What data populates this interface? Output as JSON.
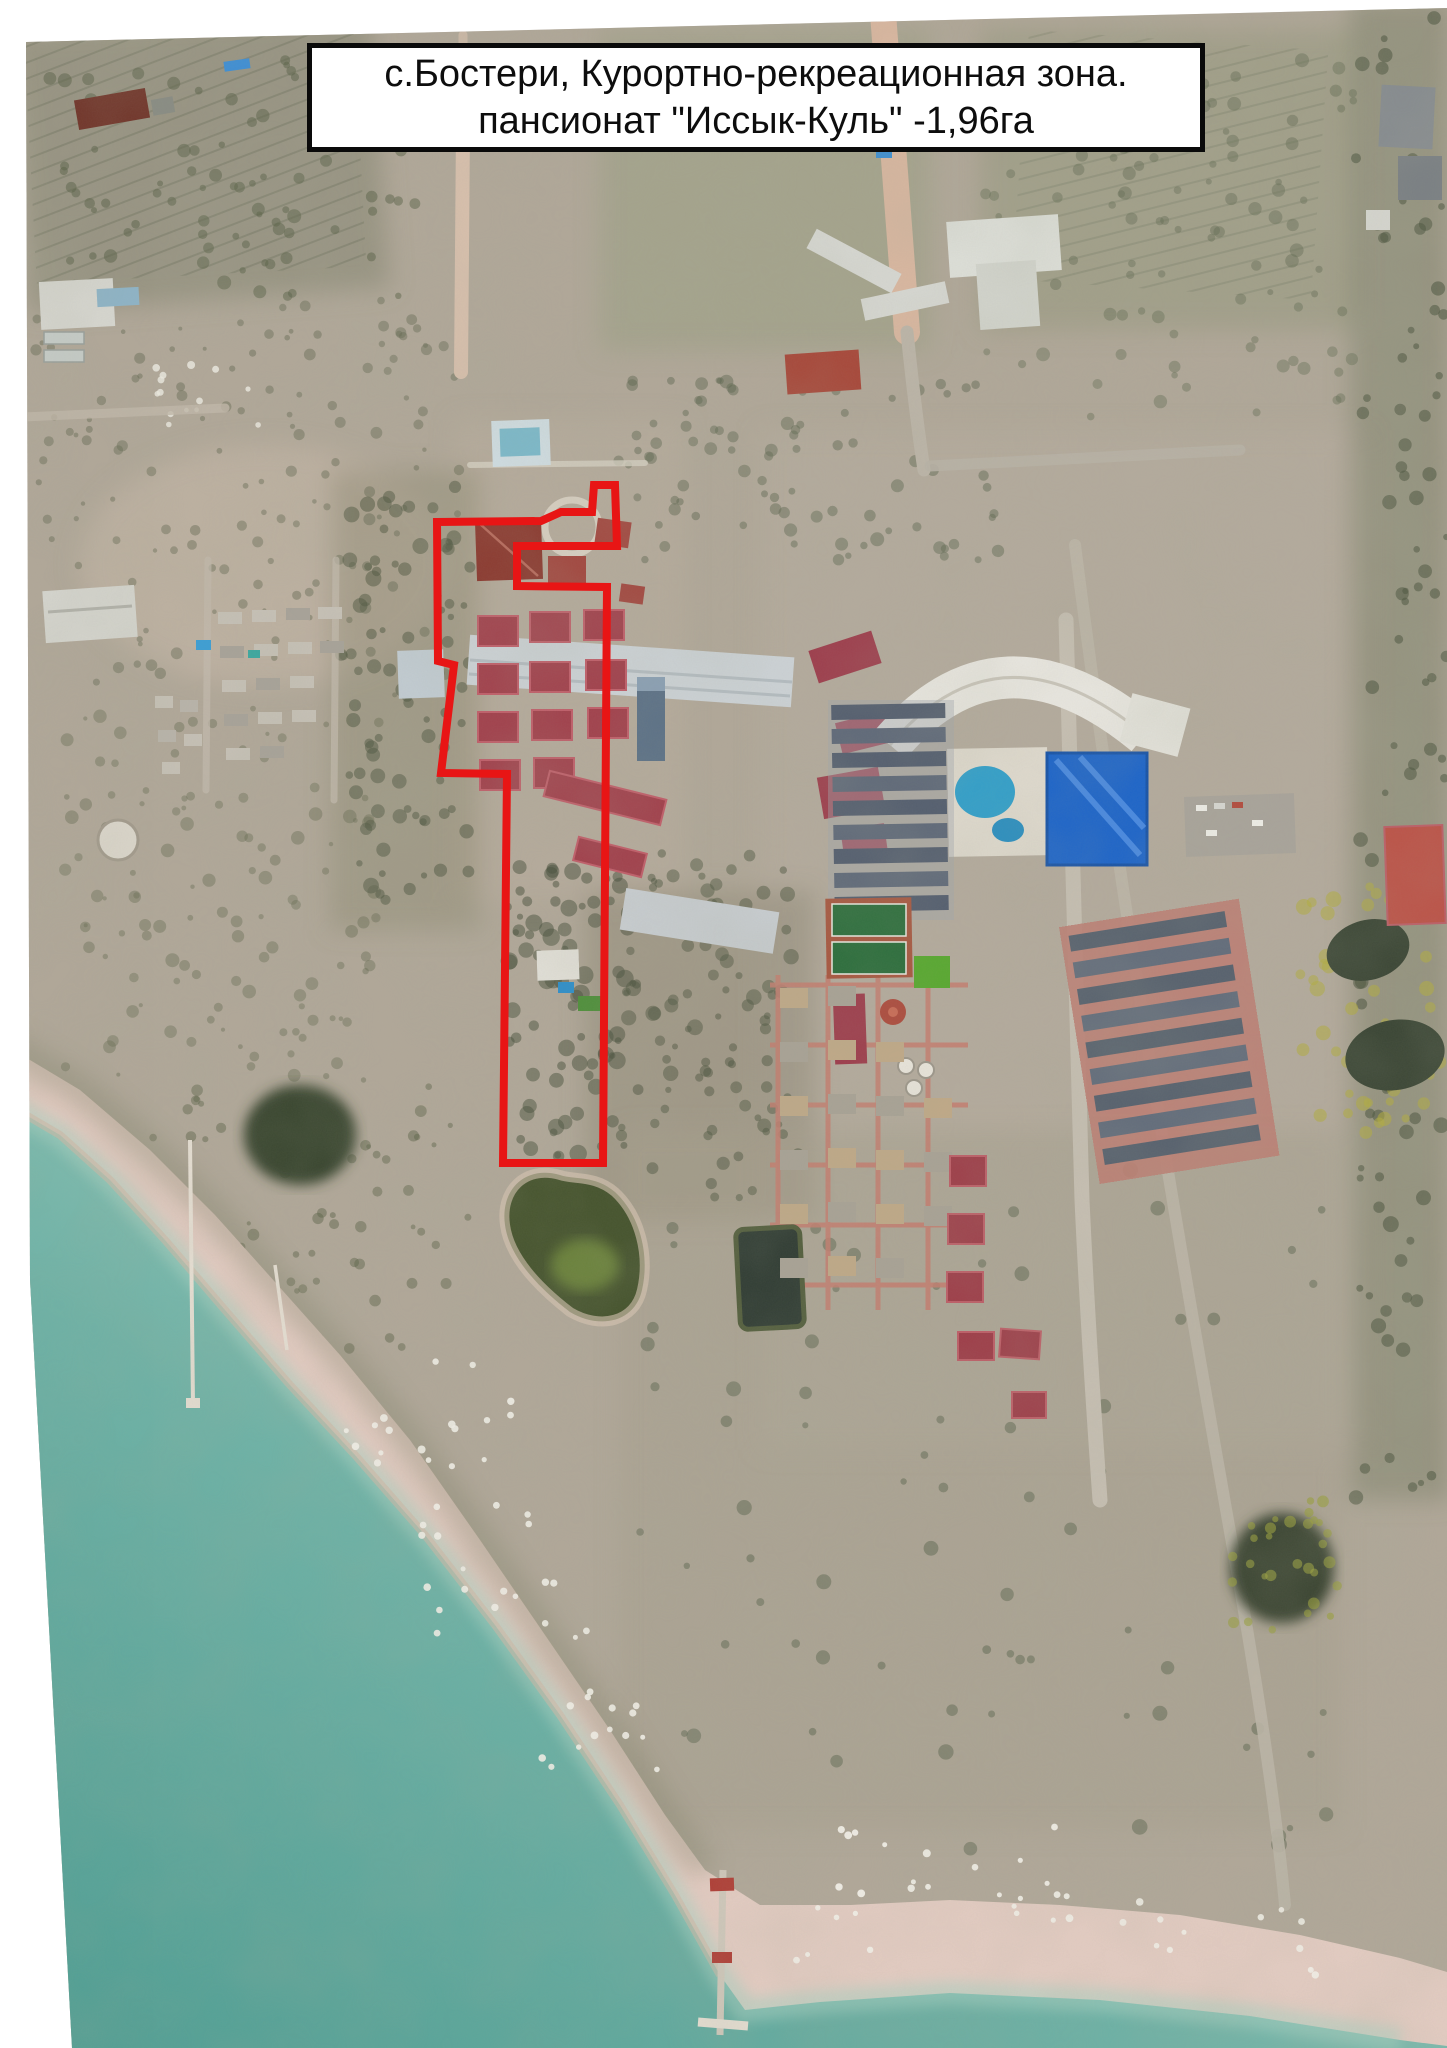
{
  "title_box": {
    "line1": "с.Бостери, Курортно-рекреационная зона.",
    "line2": "пансионат \"Иссык-Куль\" -1,96га"
  },
  "parcel_outline": {
    "color": "#e81515",
    "stroke_width": 8,
    "points": [
      [
        437,
        522
      ],
      [
        541,
        521
      ],
      [
        561,
        512
      ],
      [
        592,
        512
      ],
      [
        594,
        485
      ],
      [
        615,
        485
      ],
      [
        617,
        546
      ],
      [
        517,
        546
      ],
      [
        517,
        586
      ],
      [
        607,
        587
      ],
      [
        603,
        1163
      ],
      [
        503,
        1163
      ],
      [
        507,
        774
      ],
      [
        441,
        773
      ],
      [
        454,
        665
      ],
      [
        438,
        661
      ]
    ]
  },
  "palette": {
    "page_background": "#ffffff",
    "water_deep": "#4f9e93",
    "water_shallow": "#9ccabb",
    "beach_sand": "#e3ccc2",
    "land_base": "#aba495",
    "vegetation_dark": "#5c624c",
    "roof_red": "#a2434e",
    "roof_dark_red": "#8c3a30",
    "roof_slate": "#59636f",
    "roof_white": "#dfe0da",
    "pool_blue": "#2f8fc9",
    "building_blue": "#1f66c9",
    "road_dirt": "#d6b49c",
    "resort_path_pink": "#c57e70",
    "outline_red": "#e81515"
  }
}
